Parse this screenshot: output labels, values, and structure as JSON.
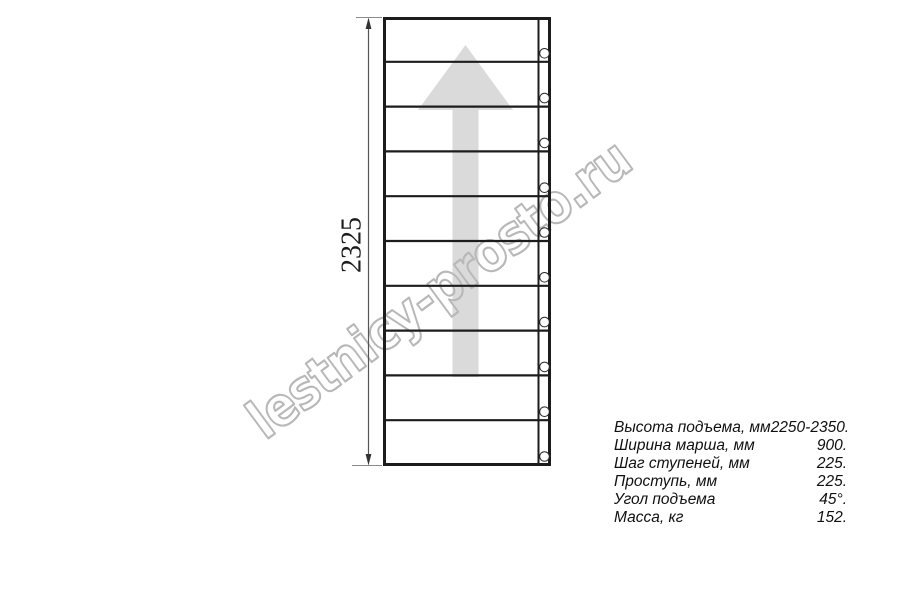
{
  "page": {
    "background_color": "#ffffff"
  },
  "drawing": {
    "type": "staircase-plan-top-view",
    "dimension_label": "2325",
    "treads_count": 10,
    "fastener_count": 10,
    "line_color": "#1c1c1c",
    "arrow_color": "#dadada",
    "dimension_line_color": "#555555"
  },
  "watermark": {
    "text": "lestnicy-prosto.ru",
    "color": "#b8b8b8"
  },
  "specs": {
    "rows": [
      {
        "label": "Высота подъема, мм",
        "value": "2250-2350."
      },
      {
        "label": "Ширина марша, мм",
        "value": "900."
      },
      {
        "label": "Шаг ступеней, мм",
        "value": "225."
      },
      {
        "label": "Проступь, мм",
        "value": "225."
      },
      {
        "label": "Угол подъема",
        "value": "45°."
      },
      {
        "label": "Масса, кг",
        "value": "152."
      }
    ]
  }
}
